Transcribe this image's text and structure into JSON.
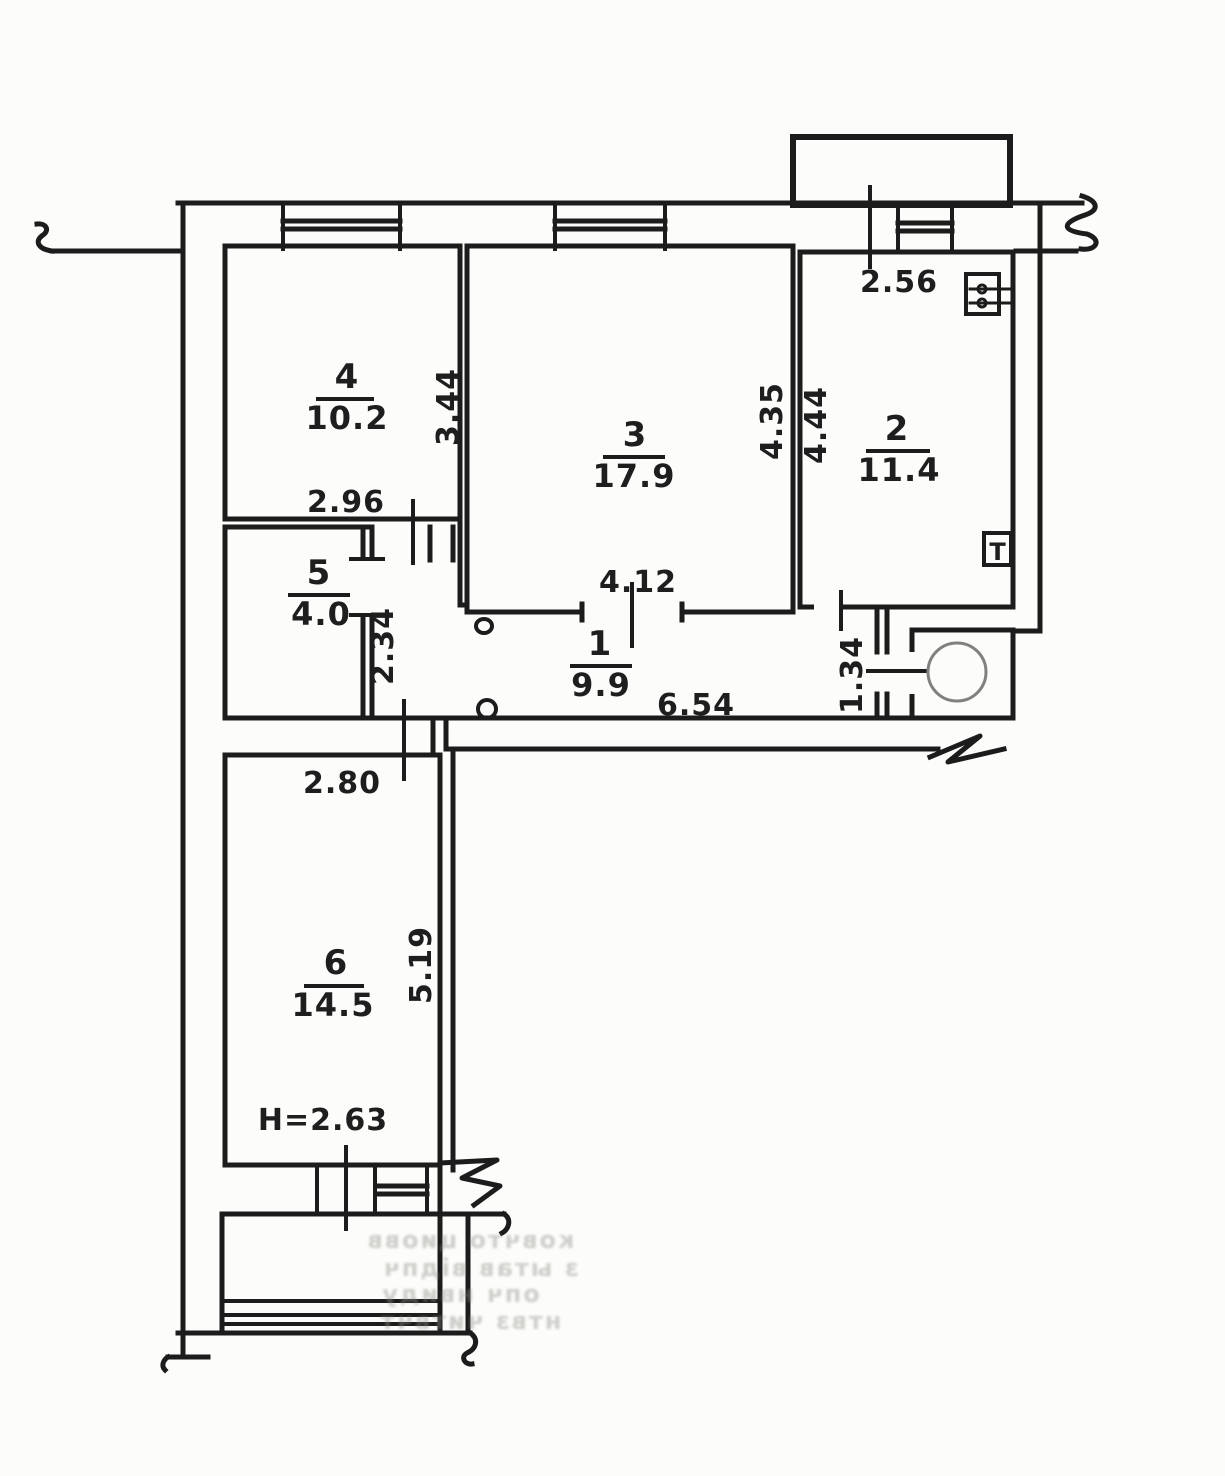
{
  "drawing": {
    "kind": "hand-drawn apartment floor plan",
    "paper_color": "#fcfcfa",
    "ink_color": "#1c1c1c",
    "faint_ink": "#8f8f88"
  },
  "rooms": [
    {
      "number": "1",
      "area": "9.9"
    },
    {
      "number": "2",
      "area": "11.4"
    },
    {
      "number": "3",
      "area": "17.9"
    },
    {
      "number": "4",
      "area": "10.2"
    },
    {
      "number": "5",
      "area": "4.0"
    },
    {
      "number": "6",
      "area": "14.5"
    }
  ],
  "dimensions": [
    {
      "value": "2.96",
      "orientation": "horizontal"
    },
    {
      "value": "3.44",
      "orientation": "vertical"
    },
    {
      "value": "4.12",
      "orientation": "horizontal"
    },
    {
      "value": "4.35",
      "orientation": "vertical"
    },
    {
      "value": "4.44",
      "orientation": "vertical"
    },
    {
      "value": "2.56",
      "orientation": "horizontal"
    },
    {
      "value": "2.34",
      "orientation": "vertical"
    },
    {
      "value": "6.54",
      "orientation": "horizontal"
    },
    {
      "value": "1.34",
      "orientation": "vertical"
    },
    {
      "value": "2.80",
      "orientation": "horizontal"
    },
    {
      "value": "5.19",
      "orientation": "vertical"
    },
    {
      "value": "H=2.63",
      "orientation": "horizontal"
    }
  ],
  "symbols": {
    "t_fixture_label": "T"
  },
  "artifacts": {
    "bleedthrough": [
      "ковчто циовв",
      "з ытав відпч",
      "опч нвиду",
      "нтвз читвчт"
    ]
  }
}
